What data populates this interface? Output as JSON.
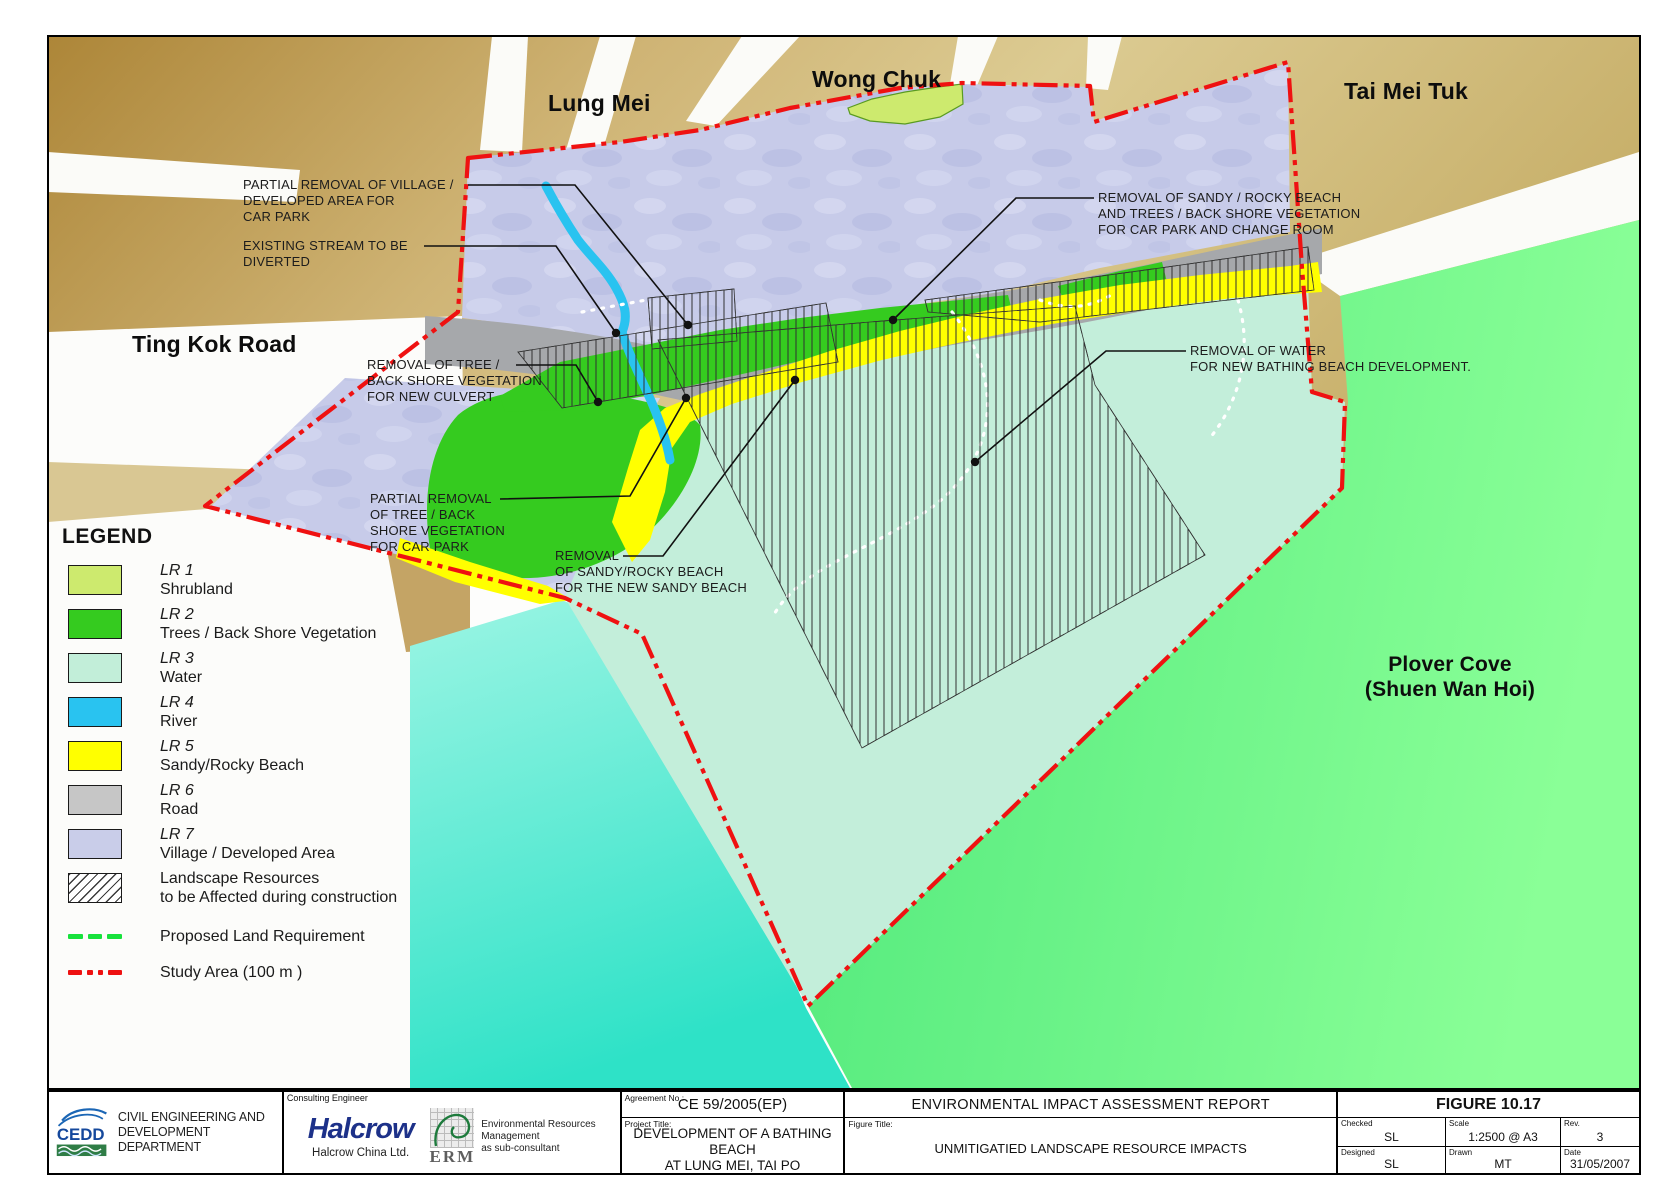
{
  "colors": {
    "study_area_red": "#ee1111",
    "proposed_land_green": "#17e23c",
    "shrubland": "#cdea6e",
    "vegetation": "#35cb1f",
    "water": "#c3eeda",
    "river": "#29c3f0",
    "beach": "#ffff00",
    "road_map": "#a6a8ab",
    "road_legend": "#c6c6c6",
    "village": "#c7cbe9",
    "sea_green": "#6cf487",
    "sea_turquoise": "#3ee6cc"
  },
  "map": {
    "places": {
      "lung_mei": "Lung Mei",
      "wong_chuk": "Wong Chuk",
      "tai_mei_tuk": "Tai Mei Tuk",
      "ting_kok_road": "Ting Kok Road",
      "plover_cove": "Plover Cove\n(Shuen Wan Hoi)"
    },
    "annotations": [
      {
        "text": "PARTIAL REMOVAL OF VILLAGE /\nDEVELOPED AREA FOR\nCAR PARK"
      },
      {
        "text": "EXISTING STREAM TO BE\nDIVERTED"
      },
      {
        "text": "REMOVAL OF TREE /\nBACK SHORE VEGETATION\nFOR NEW CULVERT"
      },
      {
        "text": "PARTIAL REMOVAL\nOF TREE / BACK\nSHORE VEGETATION\nFOR CAR PARK"
      },
      {
        "text": "REMOVAL\nOF SANDY/ROCKY BEACH\nFOR THE NEW SANDY BEACH"
      },
      {
        "text": "REMOVAL OF SANDY / ROCKY BEACH\nAND TREES / BACK SHORE VEGETATION\nFOR CAR PARK AND CHANGE ROOM"
      },
      {
        "text": "REMOVAL OF WATER\nFOR NEW BATHING BEACH DEVELOPMENT."
      }
    ]
  },
  "legend": {
    "title": "LEGEND",
    "items": [
      {
        "code": "LR 1",
        "label": "Shrubland",
        "color": "#cdea6e"
      },
      {
        "code": "LR 2",
        "label": "Trees / Back Shore Vegetation",
        "color": "#35cb1f"
      },
      {
        "code": "LR 3",
        "label": "Water",
        "color": "#c2eed9"
      },
      {
        "code": "LR 4",
        "label": "River",
        "color": "#29c3f0"
      },
      {
        "code": "LR 5",
        "label": "Sandy/Rocky Beach",
        "color": "#ffff00"
      },
      {
        "code": "LR 6",
        "label": "Road",
        "color": "#c6c6c6"
      },
      {
        "code": "LR 7",
        "label": "Village / Developed Area",
        "color": "#c9cde9"
      },
      {
        "code": "",
        "label": "Landscape Resources\nto be Affected during construction",
        "color": ""
      },
      {
        "code": "",
        "label": "Proposed Land Requirement",
        "color": "#17e23c"
      },
      {
        "code": "",
        "label": "Study Area (100 m )",
        "color": "#ee1111"
      }
    ]
  },
  "titleblock": {
    "cedd": {
      "abbr": "CEDD",
      "name": "CIVIL ENGINEERING AND\nDEVELOPMENT DEPARTMENT"
    },
    "consulting": {
      "label": "Consulting Engineer",
      "halcrow_word": "Halcrow",
      "halcrow_sub": "Halcrow China Ltd.",
      "erm_word": "ERM",
      "erm_desc": "Environmental Resources\nManagement\nas sub-consultant"
    },
    "agreement": {
      "label": "Agreement No.:",
      "value": "CE 59/2005(EP)"
    },
    "project": {
      "label": "Project Title:",
      "value": "DEVELOPMENT OF A BATHING BEACH\nAT LUNG MEI, TAI PO"
    },
    "report_title": "ENVIRONMENTAL IMPACT ASSESSMENT REPORT",
    "figure_title": {
      "label": "Figure Title:",
      "value": "UNMITIGATIED LANDSCAPE RESOURCE IMPACTS"
    },
    "figure_no": "FIGURE 10.17",
    "fields": [
      {
        "label": "Checked",
        "value": "SL"
      },
      {
        "label": "Scale",
        "value": "1:2500 @ A3"
      },
      {
        "label": "Rev.",
        "value": "3"
      },
      {
        "label": "Designed",
        "value": "SL"
      },
      {
        "label": "Drawn",
        "value": "MT"
      },
      {
        "label": "Date",
        "value": "31/05/2007"
      }
    ]
  }
}
